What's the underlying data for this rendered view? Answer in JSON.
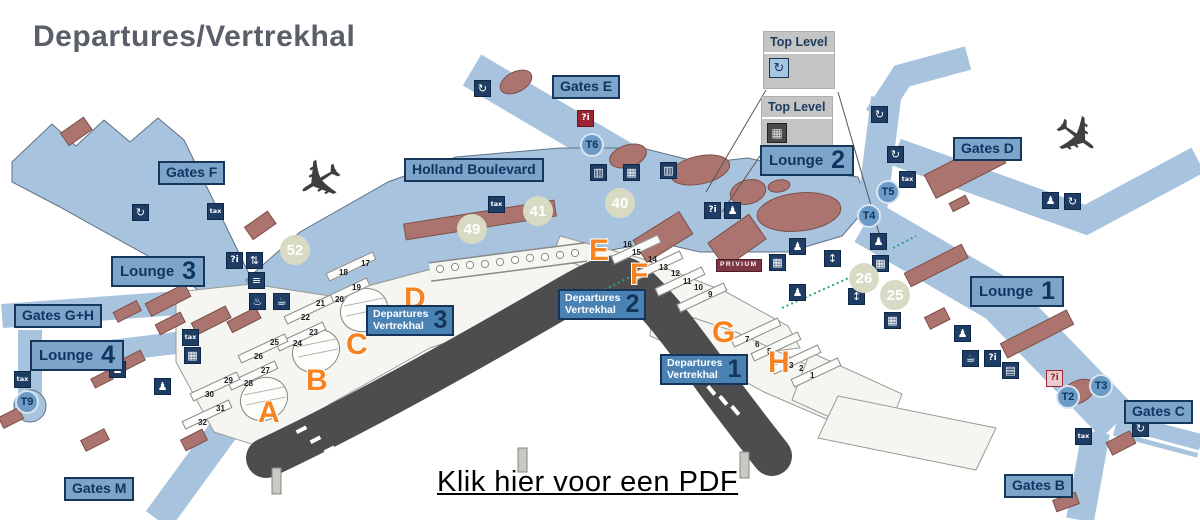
{
  "title": "Departures/Vertrekhal",
  "pdf_link": "Klik hier voor een PDF",
  "legend": {
    "boxes": [
      {
        "label": "Top Level",
        "icon": "transfer-icon",
        "glyph": "↻"
      },
      {
        "label": "Top Level",
        "icon": "locker-icon",
        "glyph": "▦"
      }
    ]
  },
  "colors": {
    "pier_blue": "#a8c3dd",
    "label_blue": "#7da5ca",
    "label_border": "#16365c",
    "departures_blue": "#4a82b4",
    "building_red": "#ab746e",
    "road_gray": "#4d4d4f",
    "accent_orange": "#f6831f",
    "area_circle_beige": "#d9dac3",
    "transit_blue": "#6d9bc7",
    "legend_gray": "#c4c4c4",
    "privium_red": "#7c3744",
    "title_gray": "#5a5f6a"
  },
  "map": {
    "boulevard": {
      "text": "Holland Boulevard"
    },
    "privium": {
      "text": "PRIVIUM"
    },
    "gate_labels": [
      {
        "name": "gates-e-label",
        "text": "Gates E",
        "x": 552,
        "y": 75
      },
      {
        "name": "gates-f-label",
        "text": "Gates F",
        "x": 158,
        "y": 161
      },
      {
        "name": "gates-d-label",
        "text": "Gates D",
        "x": 953,
        "y": 137
      },
      {
        "name": "gates-gh-label",
        "text": "Gates G+H",
        "x": 14,
        "y": 304
      },
      {
        "name": "gates-c-label",
        "text": "Gates C",
        "x": 1124,
        "y": 400
      },
      {
        "name": "gates-b-label",
        "text": "Gates B",
        "x": 1004,
        "y": 474
      },
      {
        "name": "gates-m-label",
        "text": "Gates M",
        "x": 64,
        "y": 477
      }
    ],
    "lounge_labels": [
      {
        "name": "lounge-3-label",
        "word": "Lounge",
        "num": "3",
        "x": 111,
        "y": 256
      },
      {
        "name": "lounge-2-label",
        "word": "Lounge",
        "num": "2",
        "x": 760,
        "y": 145
      },
      {
        "name": "lounge-1-label",
        "word": "Lounge",
        "num": "1",
        "x": 970,
        "y": 276
      },
      {
        "name": "lounge-4-label",
        "word": "Lounge",
        "num": "4",
        "x": 30,
        "y": 340
      }
    ],
    "departure_halls": [
      {
        "name": "departures-hall-3-label",
        "line1": "Departures",
        "line2": "Vertrekhal",
        "num": "3",
        "x": 366,
        "y": 305
      },
      {
        "name": "departures-hall-2-label",
        "line1": "Departures",
        "line2": "Vertrekhal",
        "num": "2",
        "x": 558,
        "y": 289
      },
      {
        "name": "departures-hall-1-label",
        "line1": "Departures",
        "line2": "Vertrekhal",
        "num": "1",
        "x": 660,
        "y": 354
      }
    ],
    "transit_points": [
      {
        "name": "transit-point-t6",
        "t": "T6",
        "x": 580,
        "y": 133
      },
      {
        "name": "transit-point-t5",
        "t": "T5",
        "x": 876,
        "y": 180
      },
      {
        "name": "transit-point-t4",
        "t": "T4",
        "x": 857,
        "y": 204
      },
      {
        "name": "transit-point-t9",
        "t": "T9",
        "x": 15,
        "y": 390
      },
      {
        "name": "transit-point-t2",
        "t": "T2",
        "x": 1056,
        "y": 385
      },
      {
        "name": "transit-point-t3",
        "t": "T3",
        "x": 1089,
        "y": 374
      }
    ],
    "area_numbers": [
      {
        "name": "area-number-52",
        "t": "52",
        "x": 280,
        "y": 235
      },
      {
        "name": "area-number-49",
        "t": "49",
        "x": 457,
        "y": 214
      },
      {
        "name": "area-number-41",
        "t": "41",
        "x": 523,
        "y": 196
      },
      {
        "name": "area-number-40",
        "t": "40",
        "x": 605,
        "y": 188
      },
      {
        "name": "area-number-26",
        "t": "26",
        "x": 849,
        "y": 263
      },
      {
        "name": "area-number-25",
        "t": "25",
        "x": 880,
        "y": 280
      }
    ],
    "zone_letters": [
      {
        "name": "zone-letter-a",
        "t": "A",
        "x": 258,
        "y": 398
      },
      {
        "name": "zone-letter-b",
        "t": "B",
        "x": 306,
        "y": 366
      },
      {
        "name": "zone-letter-c",
        "t": "C",
        "x": 346,
        "y": 330
      },
      {
        "name": "zone-letter-d",
        "t": "D",
        "x": 404,
        "y": 284
      },
      {
        "name": "zone-letter-e",
        "t": "E",
        "x": 589,
        "y": 236
      },
      {
        "name": "zone-letter-f",
        "t": "F",
        "x": 630,
        "y": 260
      },
      {
        "name": "zone-letter-g",
        "t": "G",
        "x": 712,
        "y": 318
      },
      {
        "name": "zone-letter-h",
        "t": "H",
        "x": 768,
        "y": 348
      }
    ],
    "checkin_desk_numbers": [
      {
        "t": "1",
        "x": 810,
        "y": 372
      },
      {
        "t": "2",
        "x": 799,
        "y": 365
      },
      {
        "t": "3",
        "x": 789,
        "y": 362
      },
      {
        "t": "4",
        "x": 783,
        "y": 355
      },
      {
        "t": "5",
        "x": 767,
        "y": 348
      },
      {
        "t": "6",
        "x": 755,
        "y": 341
      },
      {
        "t": "7",
        "x": 745,
        "y": 336
      },
      {
        "t": "9",
        "x": 708,
        "y": 291
      },
      {
        "t": "10",
        "x": 694,
        "y": 284
      },
      {
        "t": "11",
        "x": 683,
        "y": 278
      },
      {
        "t": "12",
        "x": 671,
        "y": 270
      },
      {
        "t": "13",
        "x": 659,
        "y": 264
      },
      {
        "t": "14",
        "x": 648,
        "y": 256
      },
      {
        "t": "15",
        "x": 632,
        "y": 249
      },
      {
        "t": "16",
        "x": 623,
        "y": 241
      },
      {
        "t": "17",
        "x": 361,
        "y": 260
      },
      {
        "t": "18",
        "x": 339,
        "y": 269
      },
      {
        "t": "19",
        "x": 352,
        "y": 284
      },
      {
        "t": "20",
        "x": 335,
        "y": 296
      },
      {
        "t": "21",
        "x": 316,
        "y": 300
      },
      {
        "t": "22",
        "x": 301,
        "y": 314
      },
      {
        "t": "23",
        "x": 309,
        "y": 329
      },
      {
        "t": "24",
        "x": 293,
        "y": 340
      },
      {
        "t": "25",
        "x": 270,
        "y": 339
      },
      {
        "t": "26",
        "x": 254,
        "y": 353
      },
      {
        "t": "27",
        "x": 261,
        "y": 367
      },
      {
        "t": "28",
        "x": 244,
        "y": 380
      },
      {
        "t": "29",
        "x": 224,
        "y": 377
      },
      {
        "t": "30",
        "x": 205,
        "y": 391
      },
      {
        "t": "31",
        "x": 216,
        "y": 405
      },
      {
        "t": "32",
        "x": 198,
        "y": 419
      }
    ],
    "desk_rows": [
      {
        "x": 325,
        "y": 262
      },
      {
        "x": 319,
        "y": 288
      },
      {
        "x": 283,
        "y": 305
      },
      {
        "x": 275,
        "y": 332
      },
      {
        "x": 237,
        "y": 344
      },
      {
        "x": 227,
        "y": 371
      },
      {
        "x": 189,
        "y": 382
      },
      {
        "x": 181,
        "y": 410
      },
      {
        "x": 610,
        "y": 245
      },
      {
        "x": 632,
        "y": 261
      },
      {
        "x": 654,
        "y": 277
      },
      {
        "x": 676,
        "y": 293
      },
      {
        "x": 730,
        "y": 328
      },
      {
        "x": 750,
        "y": 342
      },
      {
        "x": 770,
        "y": 355
      },
      {
        "x": 790,
        "y": 368
      }
    ],
    "icons": [
      {
        "name": "transfer-icon",
        "glyph": "↻",
        "x": 474,
        "y": 80
      },
      {
        "name": "transfer-icon",
        "glyph": "↻",
        "x": 132,
        "y": 204
      },
      {
        "name": "tax-refund-icon",
        "glyph": "tax",
        "x": 207,
        "y": 203,
        "cls": "ic-tax"
      },
      {
        "name": "info-icon",
        "glyph": "?i",
        "x": 226,
        "y": 252,
        "cls": "ic-info"
      },
      {
        "name": "escalator-icon",
        "glyph": "⇅",
        "x": 246,
        "y": 252
      },
      {
        "name": "stairs-icon",
        "glyph": "≡",
        "x": 248,
        "y": 272
      },
      {
        "name": "shower-icon",
        "glyph": "♨",
        "x": 249,
        "y": 293
      },
      {
        "name": "cafe-icon",
        "glyph": "☕",
        "x": 273,
        "y": 293
      },
      {
        "name": "info-icon-red",
        "glyph": "?i",
        "x": 577,
        "y": 110,
        "cls": "ic-red"
      },
      {
        "name": "baggage-icon",
        "glyph": "▥",
        "x": 590,
        "y": 164
      },
      {
        "name": "locker-icon",
        "glyph": "▦",
        "x": 623,
        "y": 164
      },
      {
        "name": "baggage-icon",
        "glyph": "▥",
        "x": 660,
        "y": 162
      },
      {
        "name": "tax-refund-icon",
        "glyph": "tax",
        "x": 488,
        "y": 196,
        "cls": "ic-tax"
      },
      {
        "name": "info-icon",
        "glyph": "?i",
        "x": 704,
        "y": 202,
        "cls": "ic-info"
      },
      {
        "name": "service-desk-icon",
        "glyph": "♟",
        "x": 724,
        "y": 202
      },
      {
        "name": "passport-icon",
        "glyph": "♟",
        "x": 789,
        "y": 238
      },
      {
        "name": "locker-icon",
        "glyph": "▦",
        "x": 769,
        "y": 254
      },
      {
        "name": "passport-icon",
        "glyph": "♟",
        "x": 789,
        "y": 284
      },
      {
        "name": "lift-icon",
        "glyph": "↕",
        "x": 824,
        "y": 250
      },
      {
        "name": "lift-icon",
        "glyph": "↕",
        "x": 848,
        "y": 288
      },
      {
        "name": "transfer-icon",
        "glyph": "↻",
        "x": 871,
        "y": 106
      },
      {
        "name": "transfer-icon",
        "glyph": "↻",
        "x": 887,
        "y": 146
      },
      {
        "name": "tax-refund-icon",
        "glyph": "tax",
        "x": 899,
        "y": 171,
        "cls": "ic-tax"
      },
      {
        "name": "passport-icon",
        "glyph": "♟",
        "x": 1042,
        "y": 192
      },
      {
        "name": "transfer-icon",
        "glyph": "↻",
        "x": 1064,
        "y": 193
      },
      {
        "name": "passport-icon",
        "glyph": "♟",
        "x": 870,
        "y": 233
      },
      {
        "name": "locker-icon",
        "glyph": "▦",
        "x": 872,
        "y": 255
      },
      {
        "name": "locker-icon",
        "glyph": "▦",
        "x": 884,
        "y": 312
      },
      {
        "name": "info-desk-icon",
        "glyph": "♟",
        "x": 954,
        "y": 325
      },
      {
        "name": "cafe-icon",
        "glyph": "☕",
        "x": 962,
        "y": 350
      },
      {
        "name": "info-icon",
        "glyph": "?i",
        "x": 984,
        "y": 350,
        "cls": "ic-info"
      },
      {
        "name": "shop-icon",
        "glyph": "▤",
        "x": 1002,
        "y": 362
      },
      {
        "name": "info-icon-pink",
        "glyph": "?i",
        "x": 1046,
        "y": 370,
        "cls": "ic-pink"
      },
      {
        "name": "tax-refund-icon",
        "glyph": "tax",
        "x": 1075,
        "y": 428,
        "cls": "ic-tax"
      },
      {
        "name": "transfer-icon",
        "glyph": "↻",
        "x": 1132,
        "y": 420
      },
      {
        "name": "tax-refund-icon",
        "glyph": "tax",
        "x": 14,
        "y": 371,
        "cls": "ic-tax"
      },
      {
        "name": "tax-refund-icon",
        "glyph": "tax",
        "x": 182,
        "y": 329,
        "cls": "ic-tax"
      },
      {
        "name": "locker-icon",
        "glyph": "▦",
        "x": 184,
        "y": 347
      },
      {
        "name": "info-desk-icon",
        "glyph": "♟",
        "x": 109,
        "y": 361
      },
      {
        "name": "passport-icon",
        "glyph": "♟",
        "x": 154,
        "y": 378
      }
    ],
    "airplanes": [
      {
        "name": "airplane-icon",
        "glyph": "✈",
        "x": 295,
        "y": 150,
        "cls": "rotA"
      },
      {
        "name": "airplane-icon",
        "glyph": "✈",
        "x": 1052,
        "y": 110,
        "cls": "rotB"
      }
    ]
  }
}
